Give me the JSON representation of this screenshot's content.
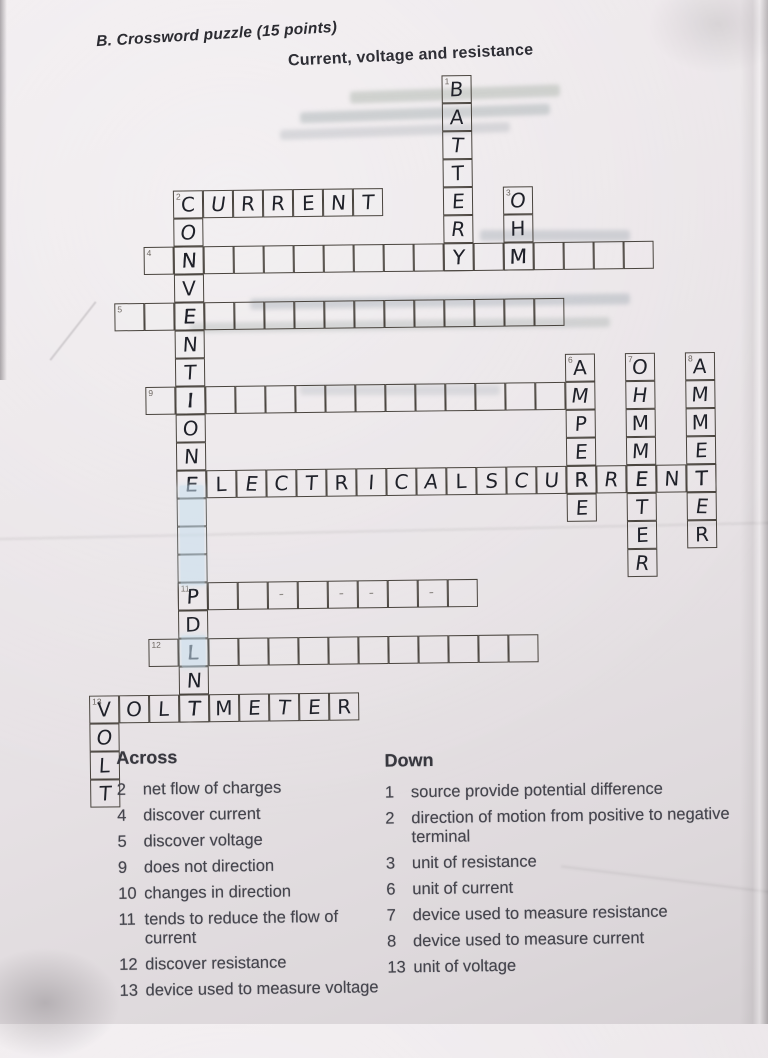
{
  "paper": {
    "section_label": "B. Crossword puzzle (15 points)",
    "title": "Current, voltage and resistance"
  },
  "grid": {
    "cell_w": 30,
    "cell_h": 28,
    "origin_x": -8,
    "origin_y": 80,
    "words": [
      {
        "id": "down-1-battery",
        "num": "1",
        "dir": "down",
        "col": 15,
        "row": 0,
        "letters": [
          "B",
          "A",
          "T",
          "T",
          "E",
          "R",
          "Y"
        ]
      },
      {
        "id": "across-2-current",
        "num": "2",
        "dir": "across",
        "col": 6,
        "row": 4,
        "letters": [
          "C",
          "U",
          "R",
          "R",
          "E",
          "N",
          "T"
        ]
      },
      {
        "id": "down-3-ohm",
        "num": "3",
        "dir": "down",
        "col": 17,
        "row": 4,
        "letters": [
          "O",
          "H",
          "M"
        ]
      },
      {
        "id": "down-2-convention",
        "num": "",
        "dir": "down",
        "col": 6,
        "row": 5,
        "letters": [
          "O",
          "N",
          "V",
          "E",
          "N",
          "T",
          "I",
          "O",
          "N",
          "E",
          "",
          "",
          "",
          "P",
          "D",
          "L",
          "N",
          "T"
        ]
      },
      {
        "id": "across-4",
        "num": "4",
        "dir": "across",
        "col": 5,
        "row": 6,
        "letters": [
          "",
          "N",
          "",
          "",
          "",
          "",
          "",
          "",
          "",
          "",
          "Y",
          "",
          "M",
          "",
          "",
          "",
          ""
        ]
      },
      {
        "id": "across-5",
        "num": "5",
        "dir": "across",
        "col": 4,
        "row": 8,
        "letters": [
          "",
          "",
          "E",
          "",
          "",
          "",
          "",
          "",
          "",
          "",
          "",
          "",
          "",
          "",
          ""
        ]
      },
      {
        "id": "down-6-ampere",
        "num": "6",
        "dir": "down",
        "col": 19,
        "row": 10,
        "letters": [
          "A",
          "M",
          "P",
          "E",
          "R",
          "E"
        ]
      },
      {
        "id": "down-7-ohmmeter",
        "num": "7",
        "dir": "down",
        "col": 21,
        "row": 10,
        "letters": [
          "O",
          "H",
          "M",
          "M",
          "E",
          "T",
          "E",
          "R"
        ]
      },
      {
        "id": "down-8-ammeter",
        "num": "8",
        "dir": "down",
        "col": 23,
        "row": 10,
        "letters": [
          "A",
          "M",
          "M",
          "E",
          "T",
          "E",
          "R"
        ]
      },
      {
        "id": "across-9",
        "num": "9",
        "dir": "across",
        "col": 5,
        "row": 11,
        "letters": [
          "",
          "I",
          "",
          "",
          "",
          "",
          "",
          "",
          "",
          "",
          "",
          "",
          "",
          ""
        ]
      },
      {
        "id": "across-10-electrical-current",
        "num": "",
        "dir": "across",
        "col": 6,
        "row": 14,
        "letters": [
          "E",
          "L",
          "E",
          "C",
          "T",
          "R",
          "I",
          "C",
          "A",
          "L",
          "S",
          "C",
          "U",
          "R",
          "R",
          "E",
          "N",
          "T"
        ]
      },
      {
        "id": "across-11",
        "num": "11",
        "dir": "across",
        "col": 6,
        "row": 18,
        "letters": [
          "P",
          "",
          "",
          "",
          "",
          "",
          "",
          "",
          "",
          ""
        ]
      },
      {
        "id": "across-12",
        "num": "12",
        "dir": "across",
        "col": 5,
        "row": 20,
        "letters": [
          "",
          "L",
          "",
          "",
          "",
          "",
          "",
          "",
          "",
          "",
          "",
          "",
          ""
        ]
      },
      {
        "id": "across-13-voltmeter",
        "num": "13",
        "dir": "across",
        "col": 3,
        "row": 22,
        "letters": [
          "V",
          "O",
          "L",
          "T",
          "M",
          "E",
          "T",
          "E",
          "R"
        ]
      },
      {
        "id": "down-13-volt",
        "num": "",
        "dir": "down",
        "col": 3,
        "row": 23,
        "letters": [
          "O",
          "L",
          "T"
        ]
      }
    ],
    "faint_marks": [
      {
        "col": 9,
        "row": 18,
        "mark": "-"
      },
      {
        "col": 11,
        "row": 18,
        "mark": "-"
      },
      {
        "col": 12,
        "row": 18,
        "mark": "-"
      },
      {
        "col": 14,
        "row": 18,
        "mark": "-"
      }
    ],
    "whiteouts": [
      {
        "col": 6,
        "row": 14.55,
        "w": 1,
        "h": 3.55
      },
      {
        "col": 6,
        "row": 19.9,
        "w": 1,
        "h": 1.15
      }
    ]
  },
  "clues": {
    "across": {
      "header": "Across",
      "items": [
        {
          "num": "2",
          "text": "net flow of charges"
        },
        {
          "num": "4",
          "text": "discover current"
        },
        {
          "num": "5",
          "text": "discover voltage"
        },
        {
          "num": "9",
          "text": "does not direction"
        },
        {
          "num": "10",
          "text": "changes in direction"
        },
        {
          "num": "11",
          "text": "tends to reduce the flow of\ncurrent"
        },
        {
          "num": "12",
          "text": "discover resistance"
        },
        {
          "num": "13",
          "text": "device used to measure voltage"
        }
      ]
    },
    "down": {
      "header": "Down",
      "items": [
        {
          "num": "1",
          "text": "source provide potential difference"
        },
        {
          "num": "2",
          "text": "direction of motion from positive to negative\nterminal"
        },
        {
          "num": "3",
          "text": "unit of resistance"
        },
        {
          "num": "6",
          "text": "unit of current"
        },
        {
          "num": "7",
          "text": "device used to measure resistance"
        },
        {
          "num": "8",
          "text": "device used to measure current"
        },
        {
          "num": "13",
          "text": "unit of voltage"
        }
      ]
    }
  }
}
